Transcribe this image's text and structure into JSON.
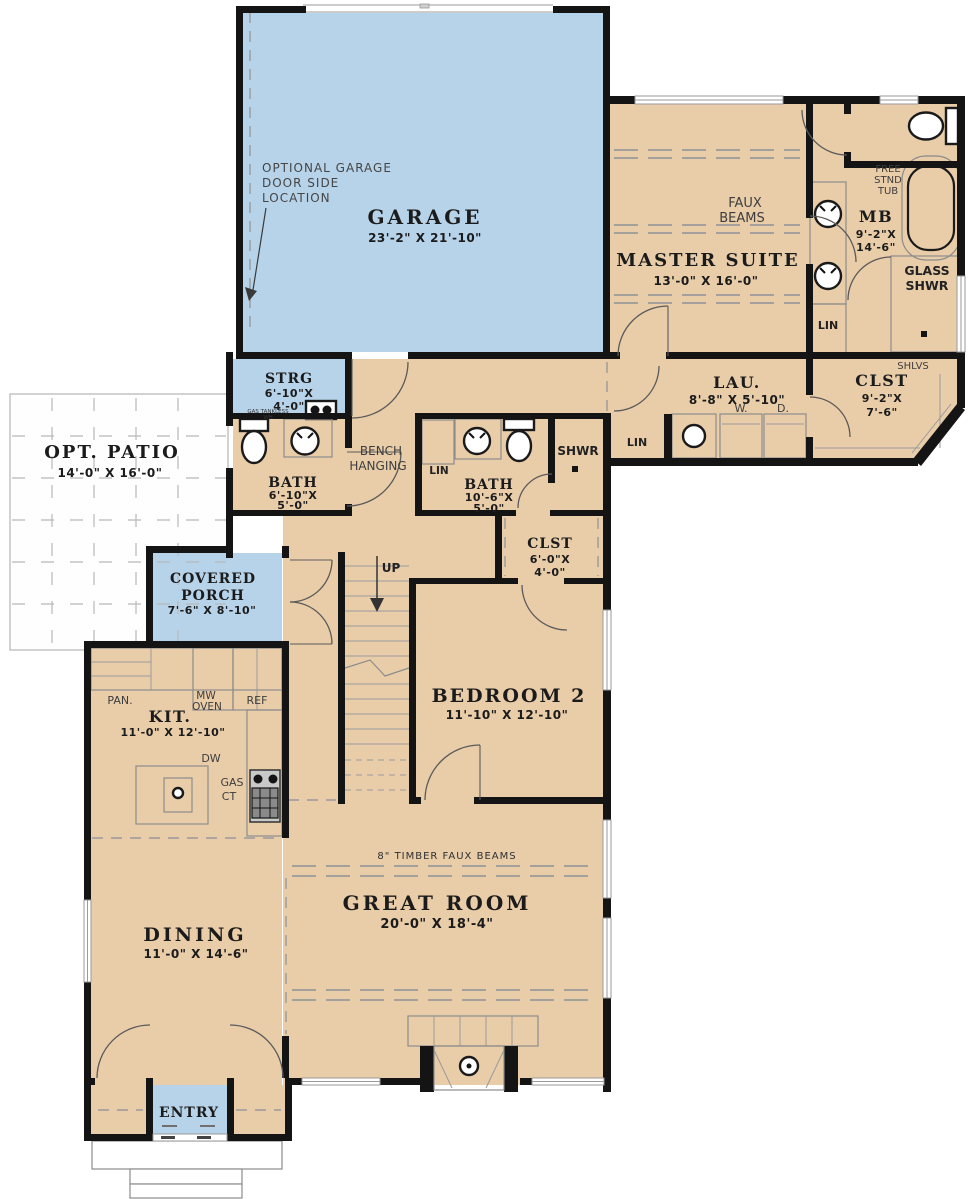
{
  "colors": {
    "room_fill": "#e9cda9",
    "highlight_fill": "#b7d3e9",
    "wall": "#141414",
    "thin_line": "#8c8c8c",
    "dash_line": "#9a9a9a"
  },
  "rooms": {
    "garage": {
      "name": "GARAGE",
      "dims": "23'-2\" X 21'-10\"",
      "option_note_l1": "OPTIONAL GARAGE",
      "option_note_l2": "DOOR SIDE",
      "option_note_l3": "LOCATION"
    },
    "master_suite": {
      "name": "MASTER SUITE",
      "dims": "13'-0\" X 16'-0\"",
      "ceiling_l1": "FAUX",
      "ceiling_l2": "BEAMS"
    },
    "master_bath": {
      "name": "MB",
      "dims_l1": "9'-2\"X",
      "dims_l2": "14'-6\"",
      "tub_l1": "FREE",
      "tub_l2": "STND",
      "tub_l3": "TUB",
      "shower_l1": "GLASS",
      "shower_l2": "SHWR",
      "linen": "LIN"
    },
    "master_closet": {
      "name": "CLST",
      "dims_l1": "9'-2\"X",
      "dims_l2": "7'-6\"",
      "shelves": "SHLVS"
    },
    "laundry": {
      "name": "LAU.",
      "dims": "8'-8\" X 5'-10\"",
      "washer": "W.",
      "dryer": "D."
    },
    "hall_linen": "LIN",
    "storage": {
      "name": "STRG",
      "dims_l1": "6'-10\"X",
      "dims_l2": "4'-0\"",
      "heater_l1": "GAS TANKLESS",
      "heater_l2": "WH"
    },
    "bath1": {
      "name": "BATH",
      "dims_l1": "6'-10\"X",
      "dims_l2": "5'-0\""
    },
    "mudroom": {
      "bench_l1": "BENCH",
      "bench_l2": "HANGING"
    },
    "bath2": {
      "name": "BATH",
      "dims_l1": "10'-6\"X",
      "dims_l2": "5'-0\"",
      "linen": "LIN",
      "shower": "SHWR"
    },
    "bedroom_closet": {
      "name": "CLST",
      "dims_l1": "6'-0\"X",
      "dims_l2": "4'-0\""
    },
    "patio": {
      "name": "OPT. PATIO",
      "dims": "14'-0\" X 16'-0\""
    },
    "porch": {
      "name_l1": "COVERED",
      "name_l2": "PORCH",
      "dims": "7'-6\" X 8'-10\""
    },
    "kitchen": {
      "name": "KIT.",
      "dims": "11'-0\" X 12'-10\"",
      "pantry": "PAN.",
      "microwave_l1": "MW",
      "microwave_l2": "OVEN",
      "refrigerator": "REF",
      "dishwasher": "DW",
      "cooktop_l1": "GAS",
      "cooktop_l2": "CT"
    },
    "stairs": {
      "direction": "UP"
    },
    "bedroom2": {
      "name": "BEDROOM 2",
      "dims": "11'-10\" X 12'-10\""
    },
    "great_room": {
      "name": "GREAT ROOM",
      "dims": "20'-0\" X 18'-4\"",
      "ceiling": "8\" TIMBER FAUX BEAMS"
    },
    "dining": {
      "name": "DINING",
      "dims": "11'-0\" X 14'-6\""
    },
    "entry": {
      "name": "ENTRY"
    }
  }
}
